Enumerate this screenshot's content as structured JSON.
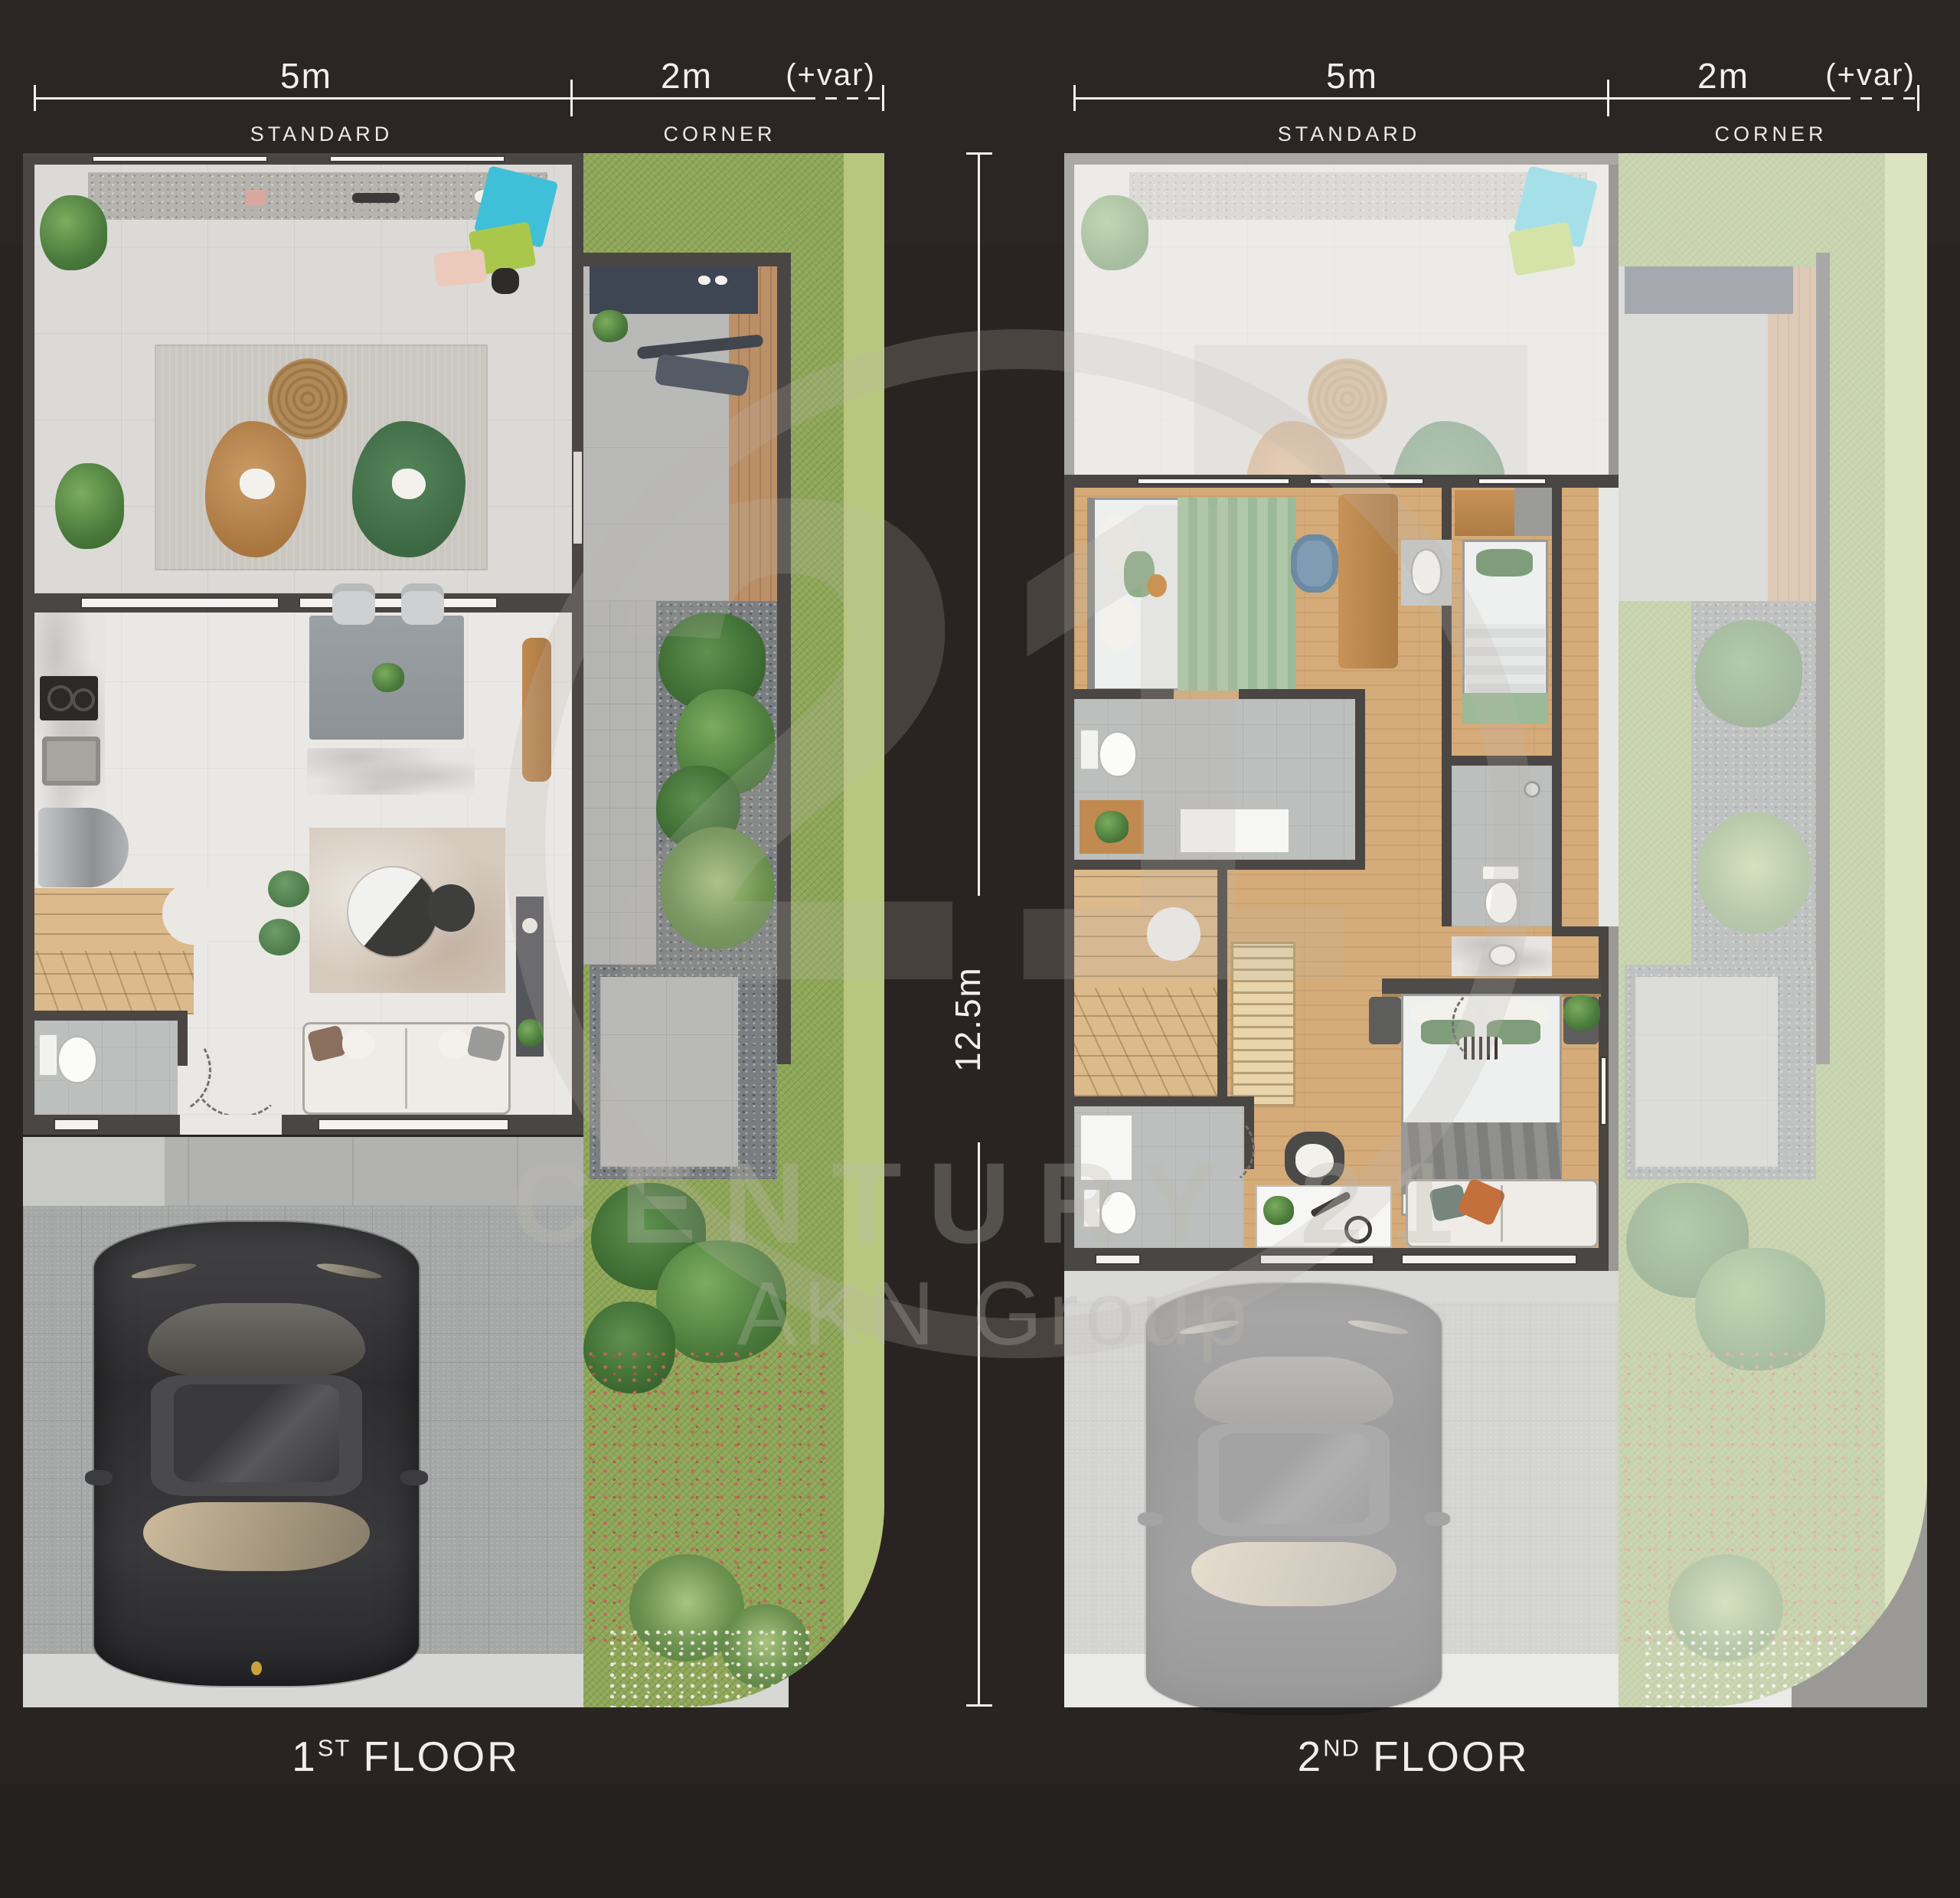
{
  "rulers": {
    "standard_value": "5m",
    "corner_value": "2m",
    "variable_value": "(+var)",
    "standard_label": "STANDARD",
    "corner_label": "CORNER",
    "height_value": "12.5m"
  },
  "floors": {
    "first": {
      "number": "1",
      "ordinal": "ST",
      "word": "FLOOR"
    },
    "second": {
      "number": "2",
      "ordinal": "ND",
      "word": "FLOOR"
    }
  },
  "watermark": {
    "number": "21",
    "brand": "CENTURY 21",
    "group": "AKN Group"
  },
  "palette": {
    "background": "#292421",
    "ruler_line": "#f2f0ed",
    "wall": "#4a4644",
    "terrace_tile": "#dcdad6",
    "interior_floor": "#eae8e4",
    "wood_floor_2f": "#d5ab79",
    "wood_deck": "#bb9068",
    "driveway": "#a6a8a7",
    "sidewalk": "#d7d7d5",
    "grass": "#8ea757",
    "olive_boundary": "#b8c77e",
    "mat_cyan": "#3fc0d8",
    "mat_lime": "#a9c84b",
    "bean_bag_tan": "#c18f5e",
    "bean_bag_green": "#4e7c52",
    "watermark_gray": "rgba(190,184,176,0.30)"
  }
}
